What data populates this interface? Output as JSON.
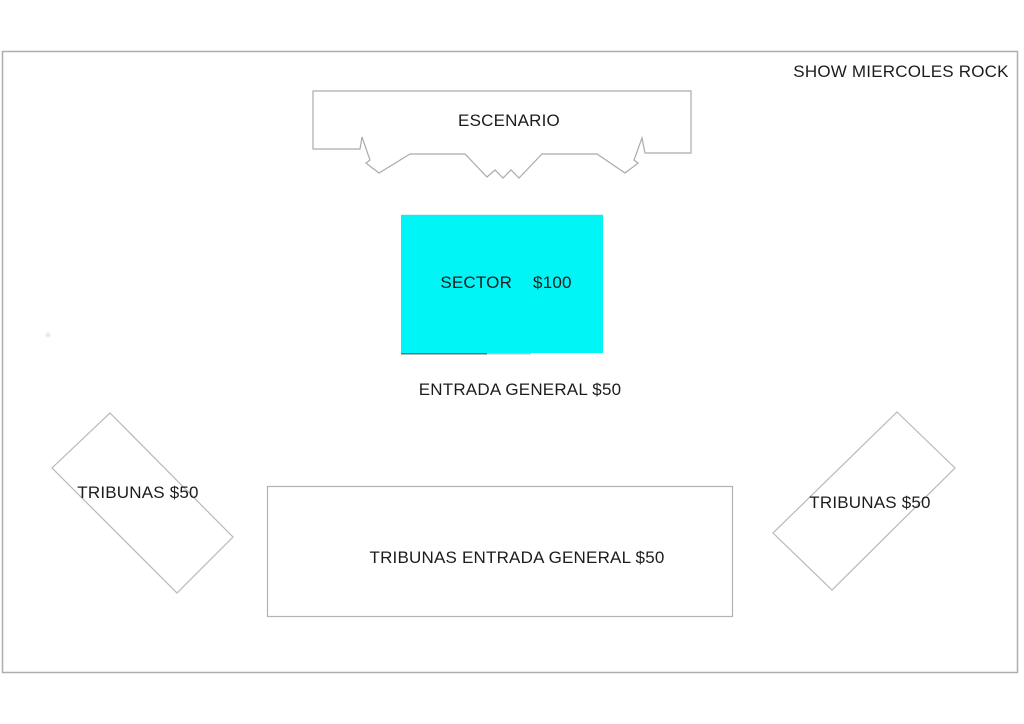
{
  "title": "SHOW MIERCOLES ROCK",
  "colors": {
    "sector_fill": "#00f6f6",
    "line": "#ababab",
    "text": "#1c1c1c"
  },
  "stage": {
    "label": "ESCENARIO"
  },
  "sector": {
    "label": "SECTOR",
    "price": "$100"
  },
  "entrada_general": {
    "label": "ENTRADA GENERAL $50"
  },
  "tribunas_left": {
    "label": "TRIBUNAS $50"
  },
  "tribunas_right": {
    "label": "TRIBUNAS $50"
  },
  "tribunas_entrada_general": {
    "label": "TRIBUNAS ENTRADA GENERAL $50"
  }
}
